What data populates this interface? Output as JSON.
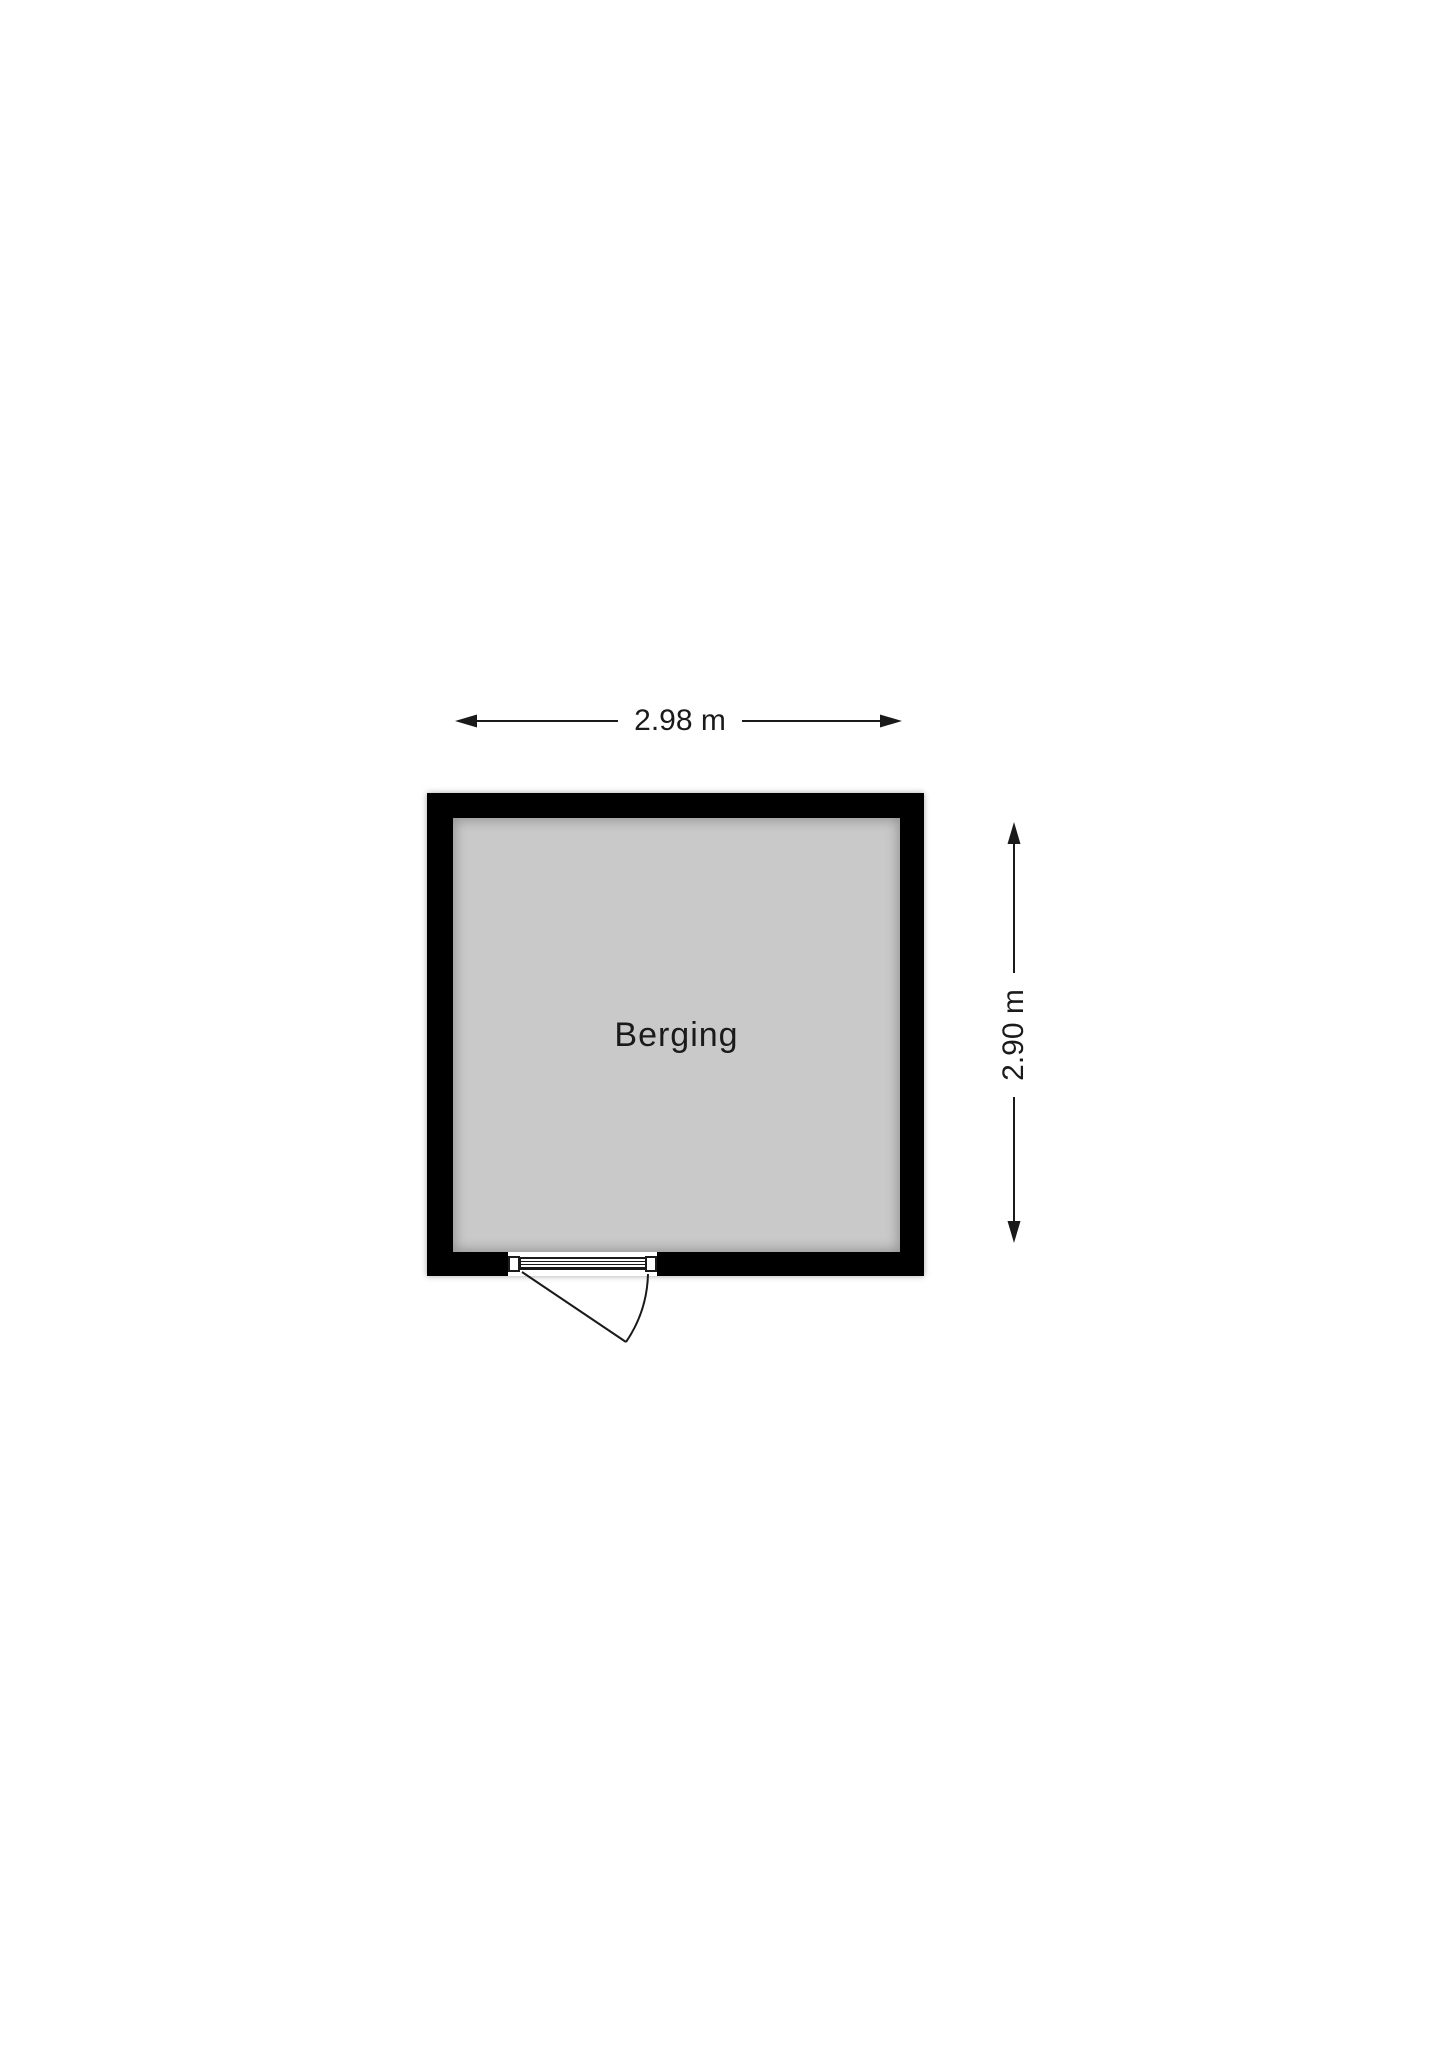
{
  "floorplan": {
    "room": {
      "label": "Berging"
    },
    "dimensions": {
      "width_label": "2.98 m",
      "height_label": "2.90 m"
    },
    "colors": {
      "wall": "#000000",
      "floor": "#c9c9c9",
      "ink": "#1a1a1a",
      "background": "#ffffff"
    }
  }
}
